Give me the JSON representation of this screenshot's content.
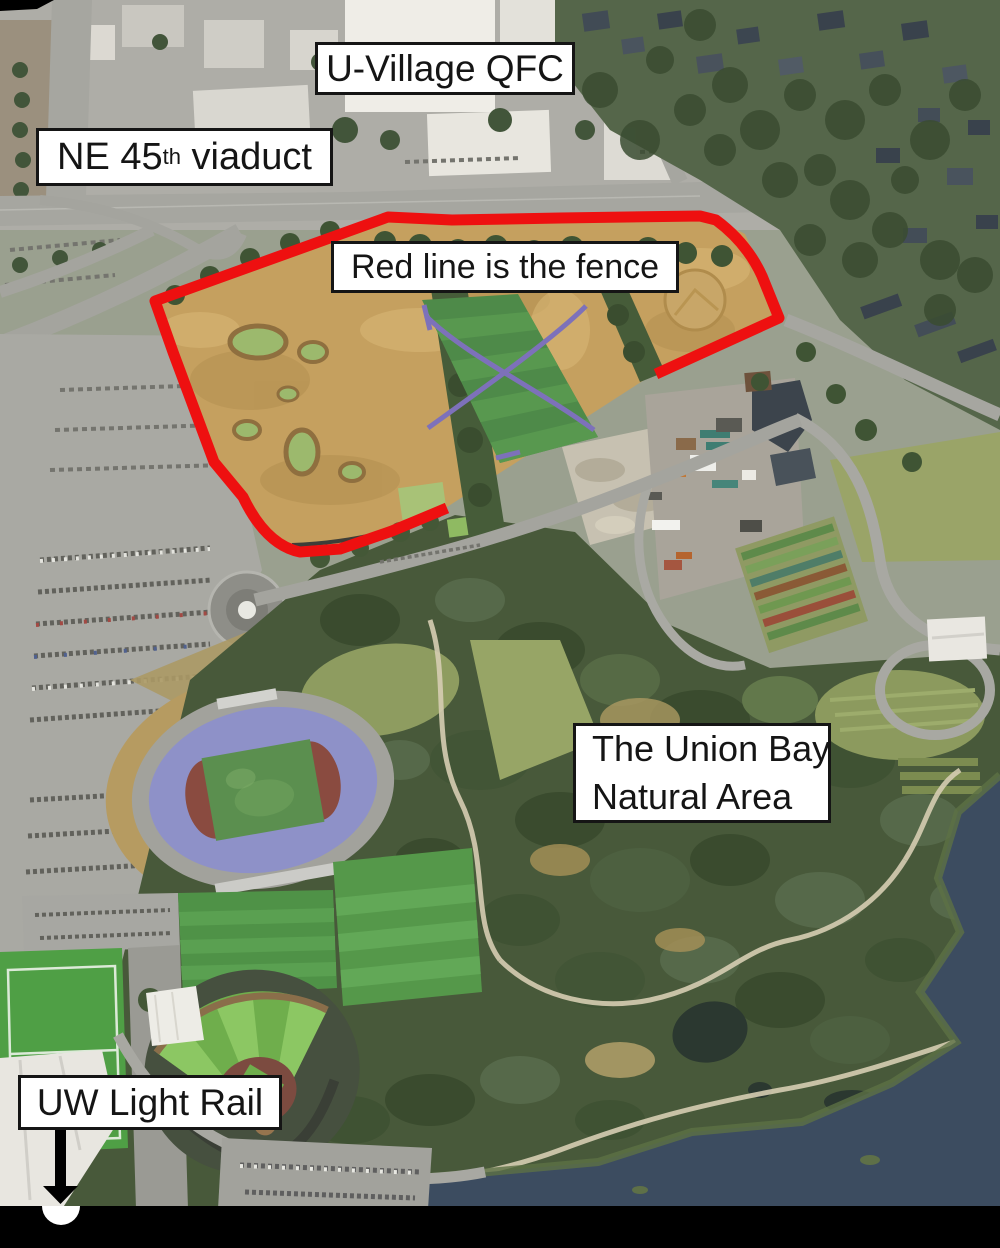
{
  "annotations": {
    "qfc": {
      "label": "U-Village QFC"
    },
    "viaduct": {
      "prefix": "NE 45",
      "sup": "th",
      "suffix": " viaduct"
    },
    "fence": {
      "label": "Red line is the fence"
    },
    "union_bay": {
      "line1": "The Union Bay",
      "line2": "Natural Area"
    },
    "light_rail": {
      "label": "UW Light Rail"
    }
  },
  "colors": {
    "fence_line": "#ee1010",
    "label_bg": "#ffffff",
    "label_border": "#151515",
    "label_text": "#151515",
    "arrow": "#000000",
    "letterbox": "#000000",
    "station_marker": "#ffffff",
    "water": "#3c4c60"
  }
}
